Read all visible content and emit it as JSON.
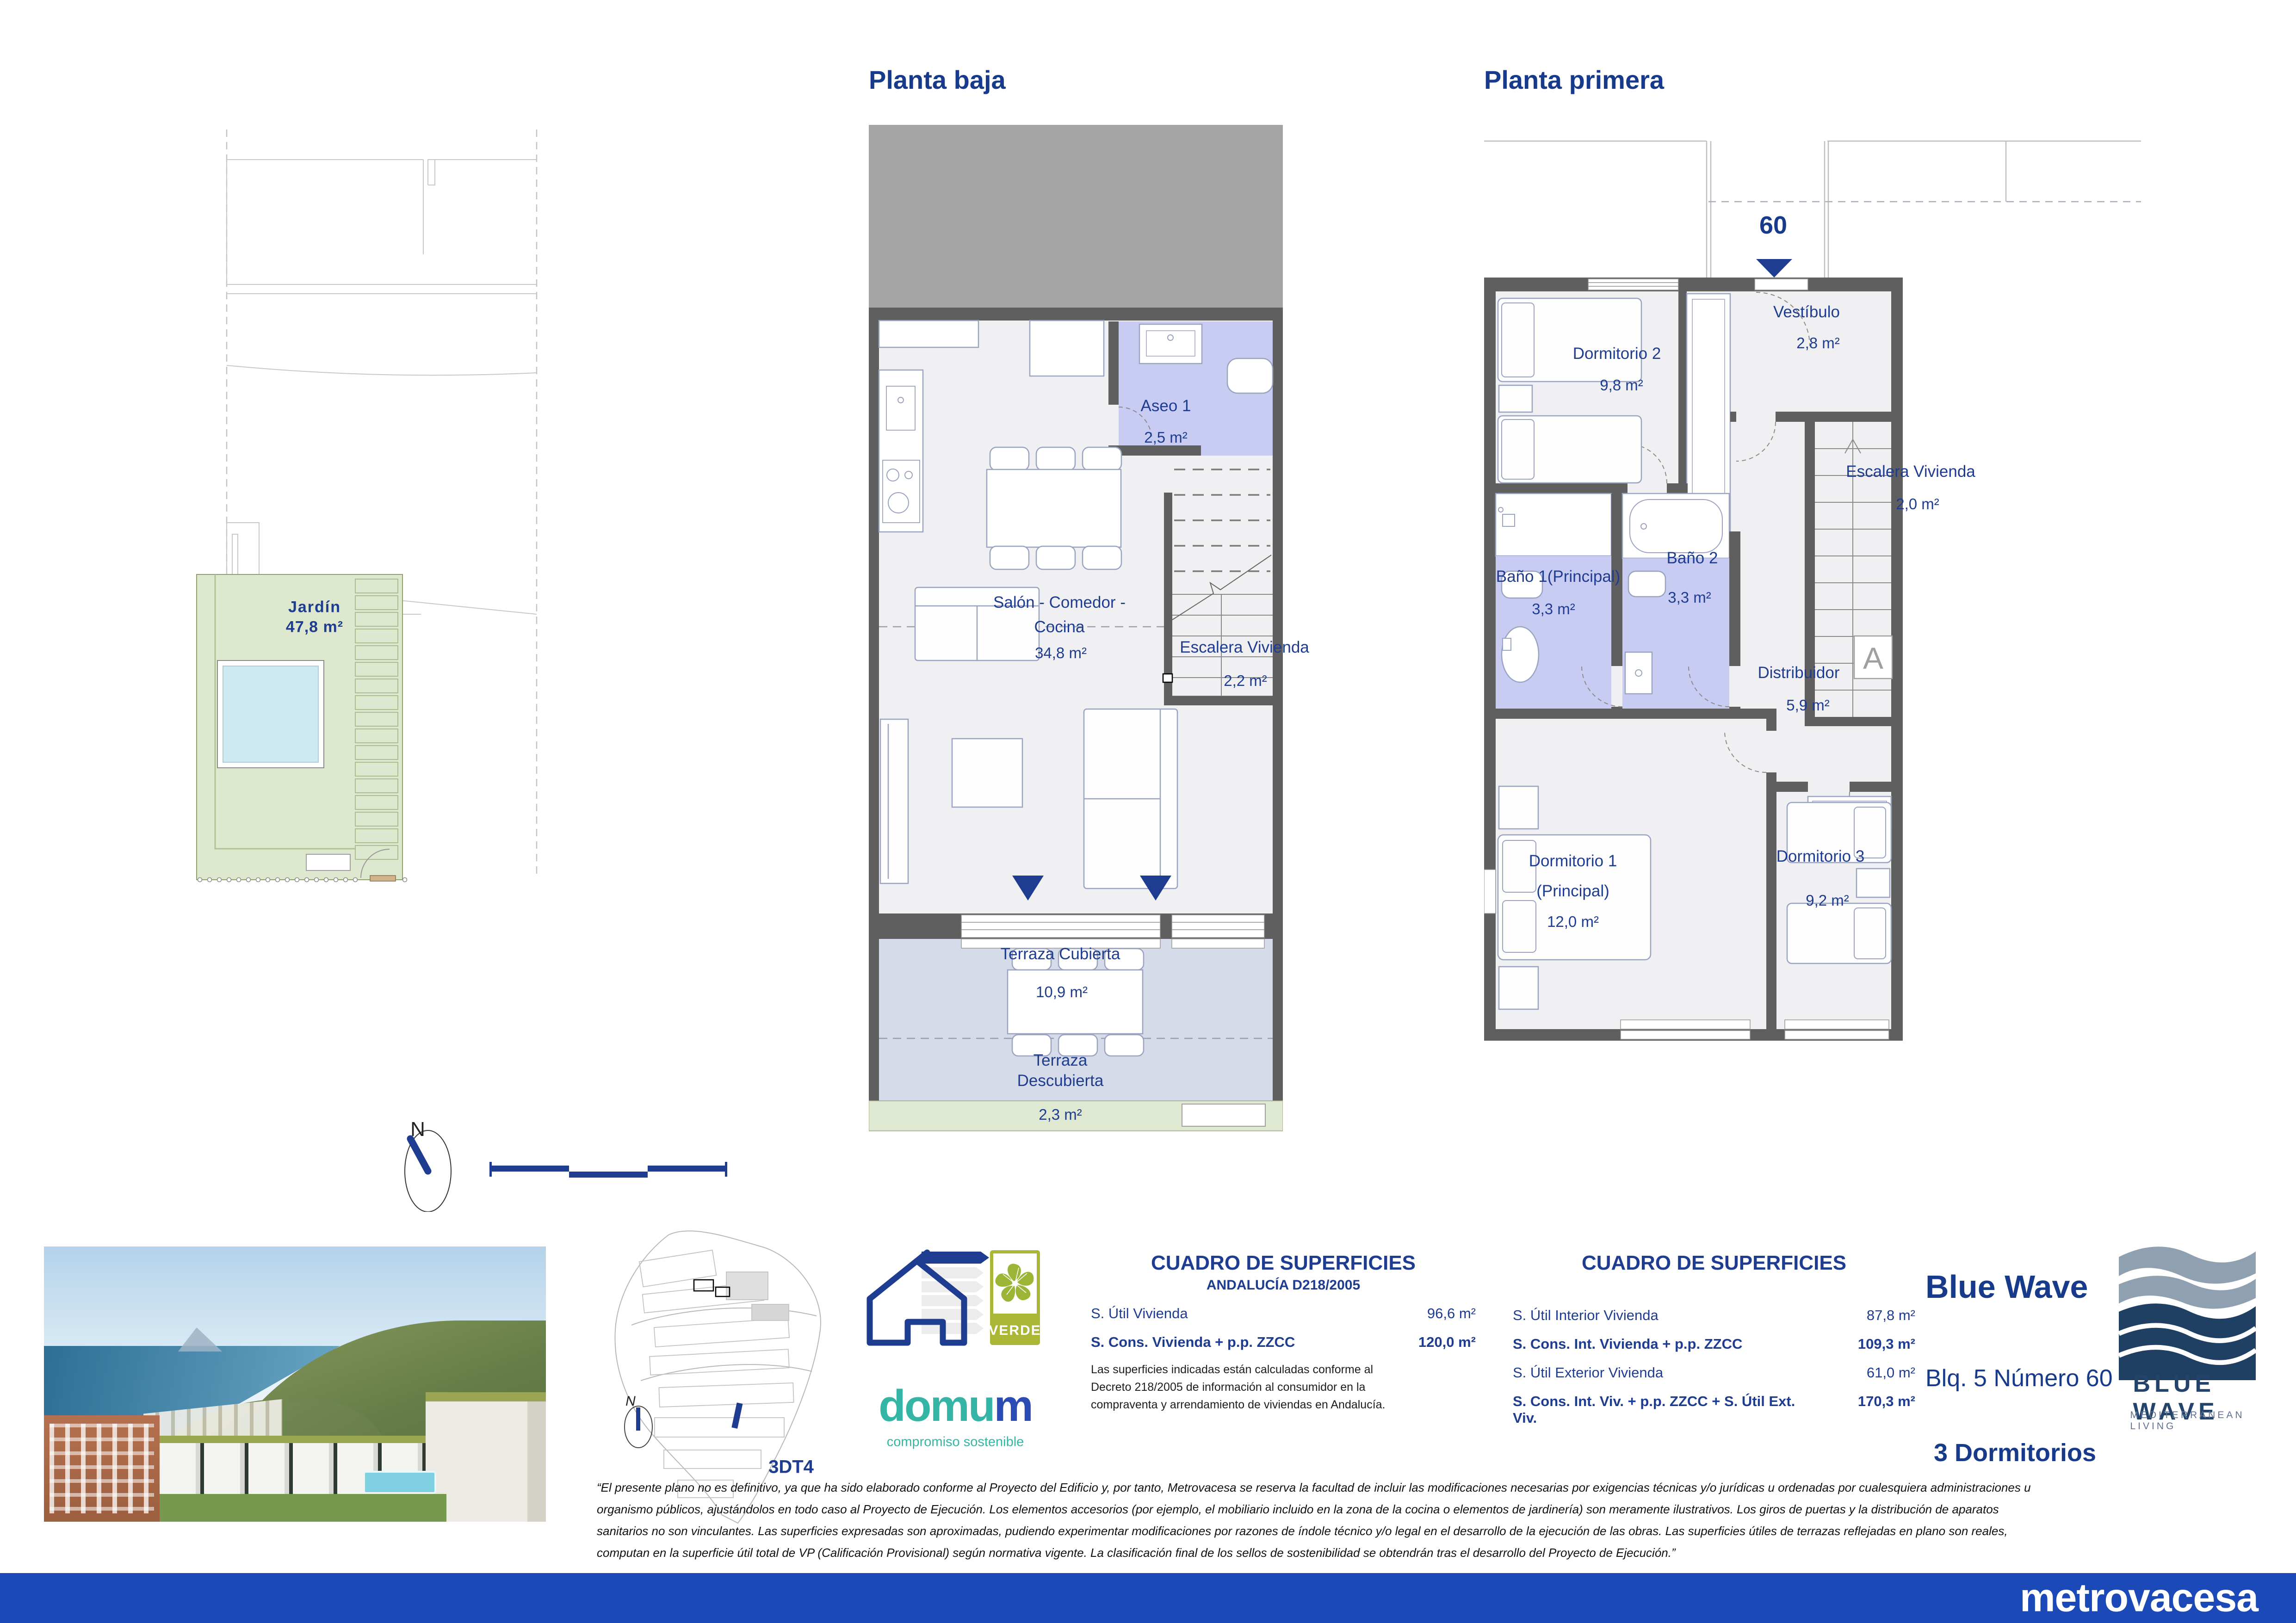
{
  "sheet": {
    "plans": {
      "planta_baja": {
        "title": "Planta baja",
        "rooms": {
          "aseo1": {
            "name": "Aseo 1",
            "area": "2,5 m²"
          },
          "salon": {
            "name_line1": "Salón - Comedor -",
            "name_line2": "Cocina",
            "area": "34,8 m²"
          },
          "escalera": {
            "name": "Escalera Vivienda",
            "area": "2,2 m²"
          },
          "terraza_cubierta": {
            "name": "Terraza Cubierta",
            "area": "10,9 m²"
          },
          "terraza_descubierta": {
            "name_line1": "Terraza",
            "name_line2": "Descubierta",
            "area": "2,3 m²"
          }
        }
      },
      "planta_primera": {
        "title": "Planta primera",
        "unit_number": "60",
        "section_marker": "A",
        "rooms": {
          "dormitorio2": {
            "name": "Dormitorio 2",
            "area": "9,8 m²"
          },
          "vestibulo": {
            "name": "Vestíbulo",
            "area": "2,8 m²"
          },
          "escalera": {
            "name": "Escalera Vivienda",
            "area": "2,0 m²"
          },
          "bano1": {
            "name": "Baño 1(Principal)",
            "area": "3,3 m²"
          },
          "bano2": {
            "name": "Baño 2",
            "area": "3,3 m²"
          },
          "distribuidor": {
            "name": "Distribuidor",
            "area": "5,9 m²"
          },
          "dormitorio1": {
            "name_line1": "Dormitorio 1",
            "name_line2": "(Principal)",
            "area": "12,0 m²"
          },
          "dormitorio3": {
            "name": "Dormitorio 3",
            "area": "9,2 m²"
          }
        }
      },
      "garden": {
        "name": "Jardín",
        "area": "47,8 m²"
      },
      "compass_label": "N"
    },
    "site_map": {
      "code": "3DT4",
      "compass_label": "N"
    },
    "surfaces_left": {
      "title": "CUADRO DE SUPERFICIES",
      "subtitle": "ANDALUCÍA D218/2005",
      "rows": [
        {
          "label": "S. Útil Vivienda",
          "value": "96,6 m²"
        },
        {
          "label": "S. Cons. Vivienda + p.p. ZZCC",
          "value": "120,0 m²"
        }
      ],
      "note_line1": "Las superficies indicadas están calculadas conforme al",
      "note_line2": "Decreto 218/2005 de información al consumidor en la",
      "note_line3": "compraventa y arrendamiento de viviendas en Andalucía."
    },
    "surfaces_right": {
      "title": "CUADRO DE SUPERFICIES",
      "rows": [
        {
          "label": "S. Útil Interior Vivienda",
          "value": "87,8 m²"
        },
        {
          "label": "S. Cons. Int. Vivienda + p.p. ZZCC",
          "value": "109,3 m²"
        },
        {
          "label": "S. Útil Exterior Vivienda",
          "value": "61,0 m²"
        },
        {
          "label": "S. Cons. Int. Viv. + p.p. ZZCC + S. Útil Ext. Viv.",
          "value": "170,3 m²"
        }
      ]
    },
    "unit_info": {
      "project": "Blue Wave",
      "block": "Blq. 5 Número 60",
      "type": "3 Dormitorios"
    },
    "branding": {
      "logo_name": "BLUE WAVE",
      "logo_tagline": "MEDITERRANEAN LIVING",
      "energy_rating": "A",
      "verde_label": "VERDE",
      "domum_prefix": "domu",
      "domum_suffix": "m",
      "domum_tagline": "compromiso sostenible",
      "developer": "metrovacesa"
    },
    "disclaimer": {
      "line1": "“El presente plano no es definitivo, ya que ha sido elaborado conforme al Proyecto del Edificio y, por tanto, Metrovacesa se reserva la facultad de incluir las modificaciones necesarias por exigencias técnicas y/o jurídicas u ordenadas por cualesquiera administraciones u",
      "line2": "organismo públicos, ajustándolos en todo caso al Proyecto de Ejecución. Los elementos accesorios (por ejemplo, el mobiliario incluido en la zona de la cocina o elementos de jardinería) son meramente ilustrativos. Los giros de puertas y la distribución de aparatos",
      "line3": "sanitarios no son vinculantes. Las superficies expresadas son aproximadas, pudiendo experimentar modificaciones por razones de índole técnico y/o legal en el desarrollo de la ejecución de las obras. Las superficies útiles de terrazas reflejadas en plano son reales,",
      "line4": "computan en la superficie útil total de VP (Calificación Provisional) según normativa vigente. La clasificación final de los sellos de sostenibilidad se obtendrán tras el desarrollo del Proyecto de Ejecución.”"
    },
    "colors": {
      "accent_navy": "#1e3c90",
      "footer_blue": "#1c49b8",
      "bath_purple": "#c9ccf2",
      "terrace_blue": "#d6dbe9",
      "garden_green": "#dde8cf",
      "verde_olive": "#a9b636",
      "domum_teal": "#35b5a5",
      "wall_gray": "#5f5f5f"
    }
  }
}
